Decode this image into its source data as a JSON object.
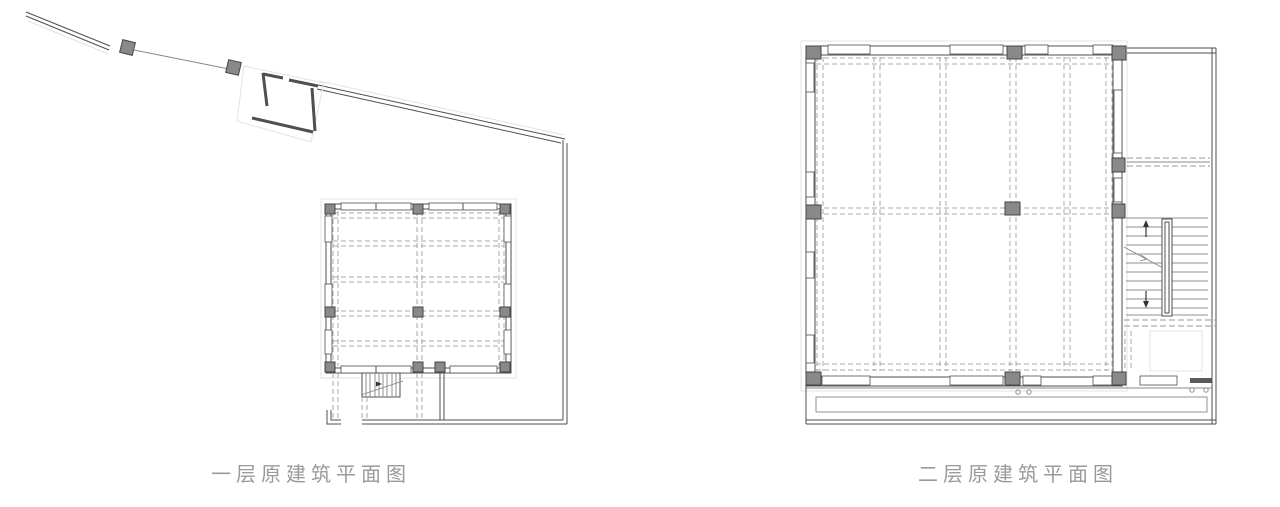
{
  "figures": [
    {
      "name": "first-floor-plan",
      "caption": "一层原建筑平面图"
    },
    {
      "name": "second-floor-plan",
      "caption": "二层原建筑平面图"
    }
  ],
  "colors": {
    "background": "#ffffff",
    "wall": "#4f4f4f",
    "column_fill": "#898989",
    "column_stroke": "#454545",
    "dashed_grid": "#a9a9a9",
    "dashed_dark": "#9a9a9a",
    "faint_outline": "#e3e3e3",
    "stair_tread": "#8f8f8f",
    "caption_text": "#9a9a9a"
  }
}
